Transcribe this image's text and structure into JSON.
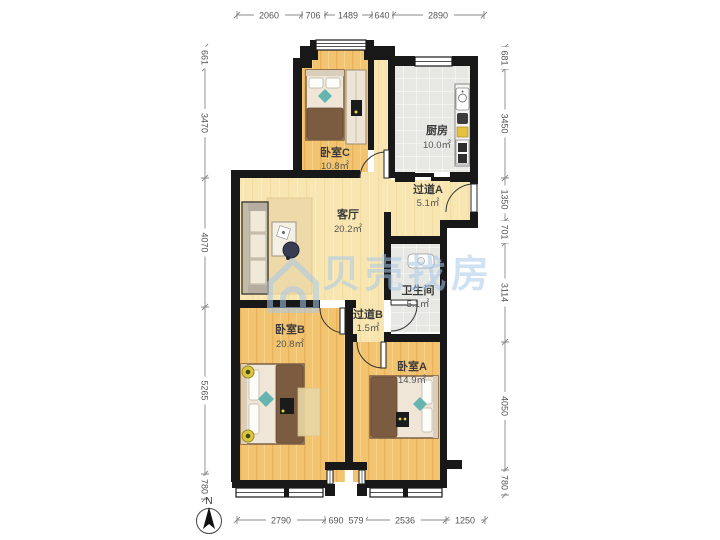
{
  "watermark": {
    "text": "贝壳找房"
  },
  "compass": {
    "label": "N"
  },
  "rooms": [
    {
      "id": "bedroom-c",
      "name": "卧室C",
      "area": "10.8㎡"
    },
    {
      "id": "kitchen",
      "name": "厨房",
      "area": "10.0㎡"
    },
    {
      "id": "hallway-a",
      "name": "过道A",
      "area": "5.1㎡"
    },
    {
      "id": "living-room",
      "name": "客厅",
      "area": "20.2㎡"
    },
    {
      "id": "bathroom",
      "name": "卫生间",
      "area": "5.1㎡"
    },
    {
      "id": "hallway-b",
      "name": "过道B",
      "area": "1.5㎡"
    },
    {
      "id": "bedroom-b",
      "name": "卧室B",
      "area": "20.8㎡"
    },
    {
      "id": "bedroom-a",
      "name": "卧室A",
      "area": "14.9㎡"
    }
  ],
  "dimensions_mm": {
    "top": [
      "2060",
      "706",
      "1489",
      "640",
      "2890"
    ],
    "bottom": [
      "2790",
      "690",
      "579",
      "2536",
      "1250"
    ],
    "left": [
      "661",
      "3470",
      "4070",
      "5265",
      "780"
    ],
    "right": [
      "681",
      "3450",
      "1350",
      "701",
      "3114",
      "4050",
      "780"
    ]
  },
  "colors": {
    "wall": "#181818",
    "bedroom_floor": "#f3c470",
    "living_floor": "#f8e6b2",
    "tile_floor": "#e7e7e3",
    "watermark_blue": "#a9c9e9",
    "accent_teal": "#64b4b0",
    "blanket_brown": "#7b5c40"
  }
}
